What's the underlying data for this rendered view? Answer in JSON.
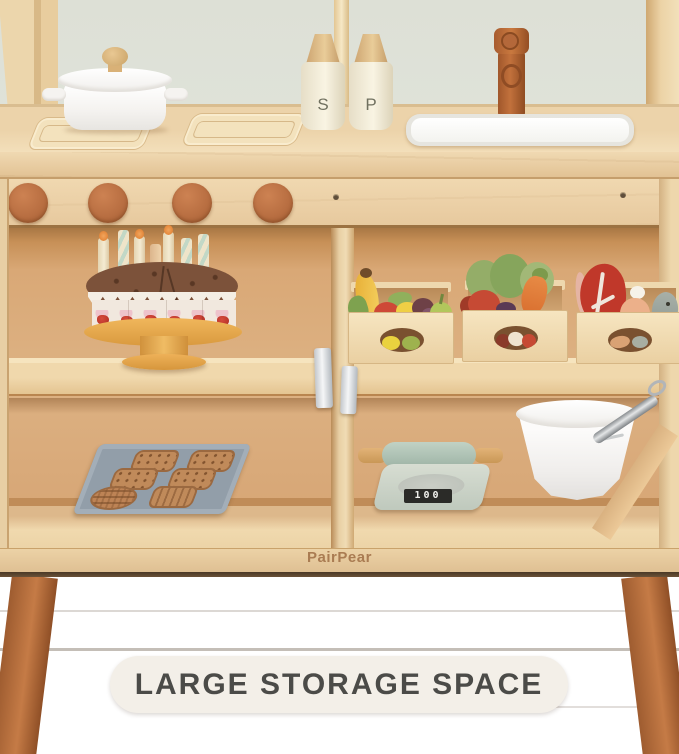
{
  "photo": {
    "brand_logo": "PairPear",
    "banner": {
      "label": "LARGE STORAGE SPACE"
    },
    "shakers": {
      "salt": "S",
      "pepper": "P"
    },
    "scale": {
      "display": "100"
    }
  },
  "palette": {
    "wall": "#dfe2d9",
    "pine_wood": "#eed6ad",
    "cabinet_interior": "#d9a876",
    "terracotta_accent": "#b96f42",
    "sage_green": "#aabfb0",
    "tray_grey": "#97a2ad",
    "floor_wood": "#9c7a55",
    "banner_bg": "#f3efe8",
    "banner_text": "#4b4b48"
  }
}
